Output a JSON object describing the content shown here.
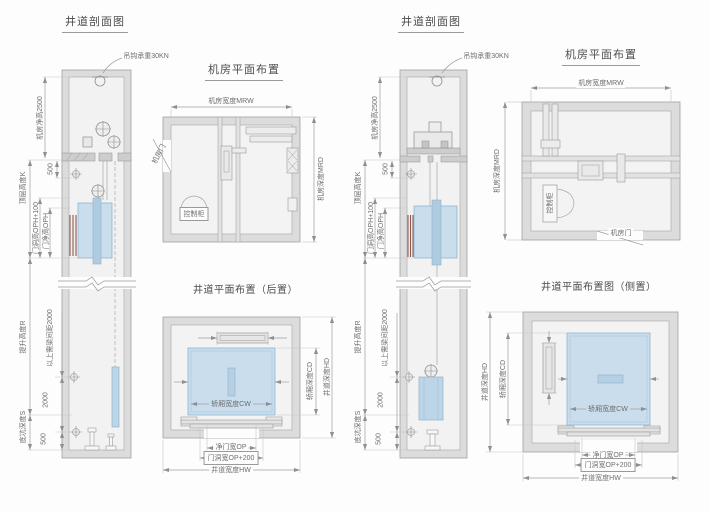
{
  "left_group": {
    "section_view": {
      "title": "井道剖面图",
      "hook_capacity": "吊钩承重30KN",
      "machine_room_clear_height": "机房净高2500",
      "dim_500_top": "500",
      "top_floor_height": "顶层高度K",
      "door_opening_height": "门洞高OPH+100",
      "door_clear_height": "门净高OPH",
      "travel_height": "提升高度R",
      "beam_spacing_note": "以上需梁间距2000",
      "dim_2000": "2000",
      "dim_500_bottom": "500",
      "pit_depth": "底坑深度S"
    },
    "machine_room_plan": {
      "title": "机房平面布置",
      "machine_room_width": "机房宽度MRW",
      "machine_room_depth": "机房深度MRD",
      "machine_room_door": "机房门",
      "control_cabinet": "控制柜"
    },
    "shaft_plan": {
      "title": "井道平面布置（后置）",
      "car_width": "轿厢宽度CW",
      "car_depth": "轿厢深度CD",
      "shaft_depth": "井道深度HD",
      "clear_door_width": "净门宽OP",
      "door_opening_width": "门洞宽OP+200",
      "shaft_width": "井道宽度HW"
    }
  },
  "right_group": {
    "section_view": {
      "title": "井道剖面图",
      "hook_capacity": "吊钩承重30KN",
      "machine_room_clear_height": "机房净高2500",
      "dim_500_top": "500",
      "top_floor_height": "顶层高度K",
      "door_opening_height": "门洞高OPH+100",
      "door_clear_height": "门净高OPH",
      "travel_height": "提升高度R",
      "beam_spacing_note": "以上需梁间距2000",
      "dim_2000": "2000",
      "dim_500_bottom": "500",
      "pit_depth": "底坑深度S"
    },
    "machine_room_plan": {
      "title": "机房平面布置",
      "machine_room_width": "机房宽度MRW",
      "machine_room_depth": "机房深度MRD",
      "machine_room_door": "机房门",
      "control_cabinet": "控制柜"
    },
    "shaft_plan": {
      "title": "井道平面布置图（侧置）",
      "car_width": "轿厢宽度CW",
      "car_depth": "轿厢深度CD",
      "shaft_depth": "井道深度HD",
      "clear_door_width": "净门宽OP",
      "door_opening_width": "门洞宽OP+200",
      "shaft_width": "井道宽度HW"
    }
  },
  "colors": {
    "wall": "#dcdcdc",
    "floor": "#f2f2f2",
    "car_blue": "#c9dded",
    "counterweight_blue": "#bdd5e8",
    "door_stripe": "#8a5a50",
    "line": "#9a9a9a"
  }
}
